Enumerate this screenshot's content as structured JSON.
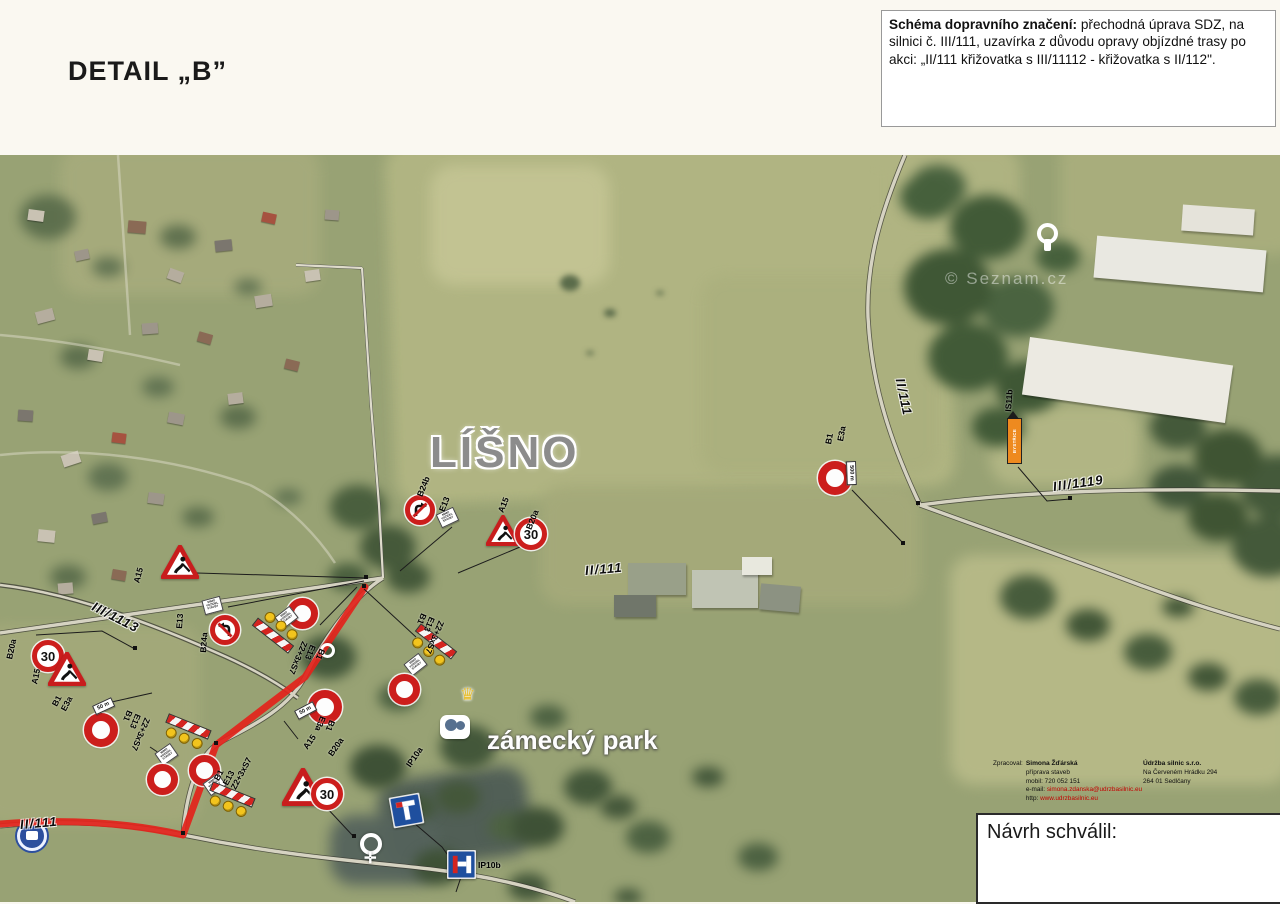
{
  "title": "DETAIL „B”",
  "note": {
    "lead": "Schéma dopravního značení:",
    "body": " přechodná úprava SDZ, na silnici č. III/111, uzavírka z důvodu opravy objízdné trasy po akci: „II/111 křižovatka s III/11112 - křižovatka s II/112\"."
  },
  "approval_label": "Návrh schválil:",
  "credits": {
    "prepared_label": "Zpracoval:",
    "name": "Simona Žďárská",
    "role": "příprava staveb",
    "mobile": "mobil: 720 052 151",
    "email_label": "e-mail:",
    "email": "simona.zdanska@udrzbasilnic.eu",
    "web_label": "http:",
    "web": "www.udrzbasilnic.eu",
    "company": "Údržba silnic s.r.o.",
    "address1": "Na Červeném Hrádku 294",
    "address2": "264 01 Sedlčany"
  },
  "places": {
    "town": "LÍŠNO",
    "park": "zámecký park",
    "watermark": "© Seznam.cz"
  },
  "roads": {
    "ii111": "II/111",
    "iii1119": "III/1119",
    "iii1113": "III/1113"
  },
  "sign_labels": {
    "a15": "A15",
    "b20a": "B20a",
    "b24a": "B24a",
    "b24b": "B24b",
    "b1": "B1",
    "e13": "E13",
    "e3a": "E3a",
    "z2": "Z2+3xS7",
    "ip10a": "IP10a",
    "ip10b": "IP10b",
    "is11b": "IS11b",
    "m500": "500 m",
    "m50": "50 m"
  },
  "sign_values": {
    "b20a_speed": "30",
    "e13_plate": "MIMO VOZIDEL STAVBY",
    "is11b_text": "BYSTŘICE"
  }
}
